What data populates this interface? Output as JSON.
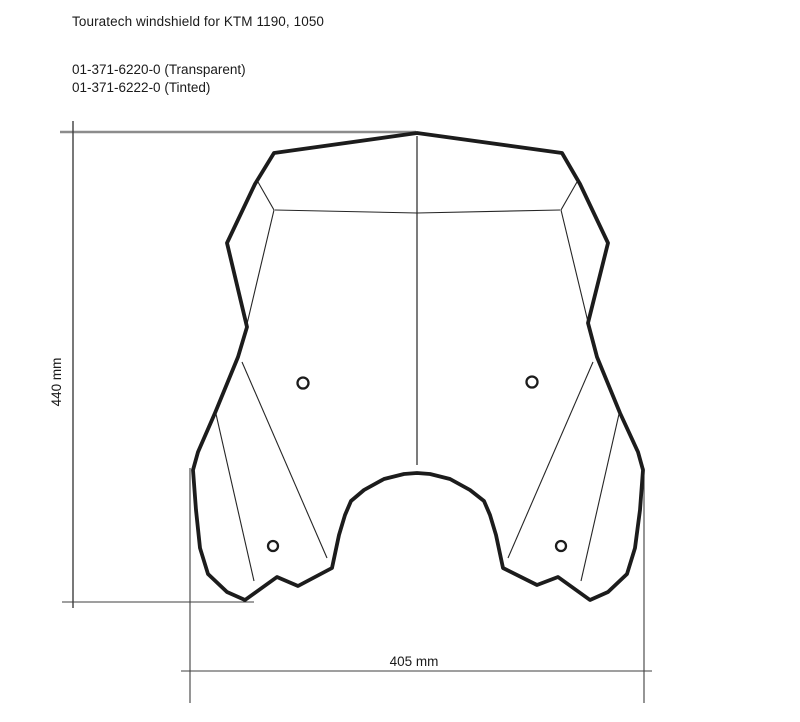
{
  "header": {
    "title": "Touratech windshield for KTM 1190, 1050",
    "part_numbers": [
      {
        "label": "01-371-6220-0 (Transparent)",
        "code": "01-371-6220-0",
        "variant": "Transparent"
      },
      {
        "label": "01-371-6222-0 (Tinted)",
        "code": "01-371-6222-0",
        "variant": "Tinted"
      }
    ]
  },
  "dimensions": {
    "height": {
      "value": 440,
      "unit": "mm",
      "label": "440 mm"
    },
    "width": {
      "value": 405,
      "unit": "mm",
      "label": "405 mm"
    }
  },
  "drawing": {
    "subject": "windshield front-view outline",
    "mounting_hole_count": 4,
    "colors": {
      "background": "#ffffff",
      "outline": "#1c1c1c",
      "crease_line": "#262626",
      "dimension_line_top": "#8c8c8c",
      "dimension_lines": "#3f3f3f",
      "text": "#1a1a1a"
    }
  }
}
